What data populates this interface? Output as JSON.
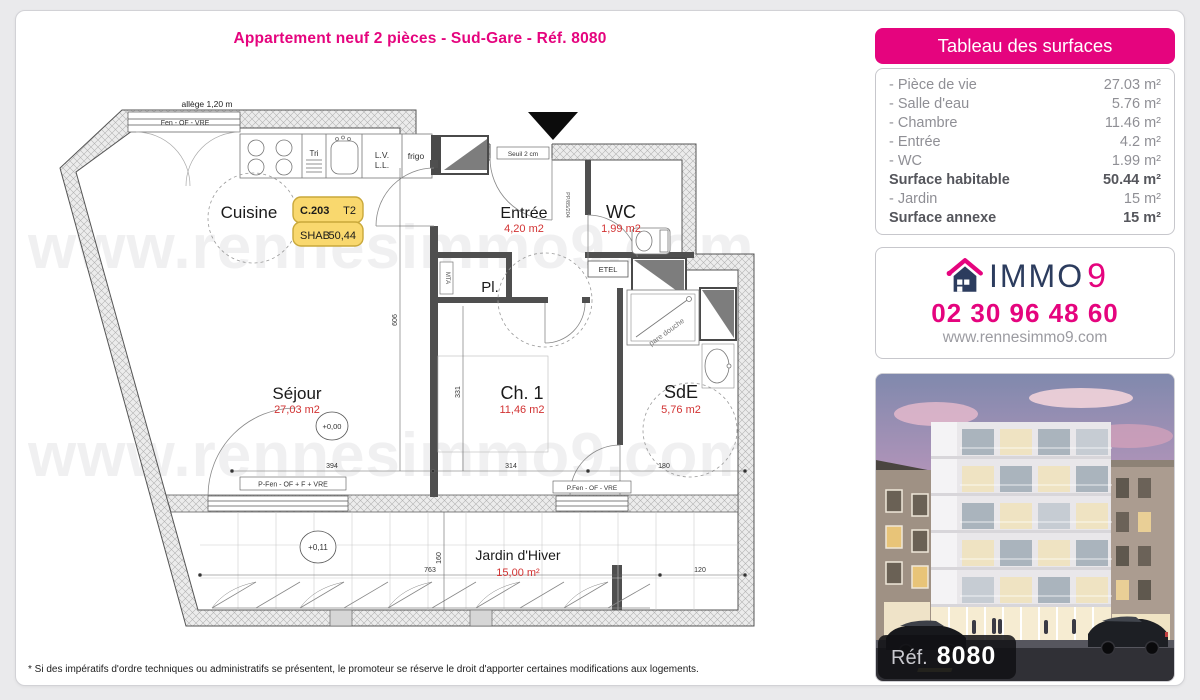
{
  "page": {
    "title": "Appartement neuf 2 pièces - Sud-Gare - Réf. 8080",
    "disclaimer": "* Si des impératifs d'ordre techniques ou administratifs se présentent, le promoteur se réserve le droit d'apporter certaines modifications aux logements."
  },
  "surfaces": {
    "header": "Tableau des surfaces",
    "rows": [
      {
        "label": "- Pièce de vie",
        "value": "27.03 m²"
      },
      {
        "label": "- Salle d'eau",
        "value": "5.76 m²"
      },
      {
        "label": "- Chambre",
        "value": "11.46 m²"
      },
      {
        "label": "- Entrée",
        "value": "4.2 m²"
      },
      {
        "label": "- WC",
        "value": "1.99 m²"
      },
      {
        "label": "Surface habitable",
        "value": "50.44 m²"
      },
      {
        "label": "- Jardin",
        "value": "15 m²"
      },
      {
        "label": "Surface annexe",
        "value": "15 m²"
      }
    ]
  },
  "agency": {
    "brand_main": "IMMO",
    "brand_digit": "9",
    "phone": "02 30 96 48 60",
    "website": "www.rennesimmo9.com"
  },
  "photo": {
    "ref_label": "Réf.",
    "ref_value": "8080"
  },
  "plan": {
    "watermark": "www.rennesimmo9.com",
    "unit_badge": {
      "unit": "C.203",
      "type": "T2",
      "shab_label": "SHAB",
      "shab_value": "50,44"
    },
    "rooms": {
      "cuisine": {
        "name": "Cuisine"
      },
      "sejour": {
        "name": "Séjour",
        "area": "27,03 m2"
      },
      "entree": {
        "name": "Entrée",
        "area": "4,20 m2"
      },
      "wc": {
        "name": "WC",
        "area": "1,99 m2"
      },
      "placard": {
        "name": "Pl."
      },
      "chambre": {
        "name": "Ch. 1",
        "area": "11,46 m2"
      },
      "sde": {
        "name": "SdE",
        "area": "5,76 m2"
      },
      "jardin": {
        "name": "Jardin d'Hiver",
        "area": "15,00 m²"
      }
    },
    "labels": {
      "allege": "allège 1,20 m",
      "fen_top": "Fen - OF - VRE",
      "seuil": "Seuil 2 cm",
      "pfen_sejour": "P-Fen - OF + F + VRE",
      "pfen_ch": "P.Fen - OF - VRE",
      "etel": "ETEL",
      "mta": "MTA",
      "pare_douche": "pare douche",
      "pp": "PP/85/204",
      "tri": "Tri",
      "lv": "L.V.",
      "ll": "L.L.",
      "frigo": "frigo",
      "level_main": "+0,00",
      "level_jardin": "+0,11"
    },
    "dims": {
      "d394": "394",
      "d314": "314",
      "d180": "180",
      "d763": "763",
      "d120": "120",
      "d606": "606",
      "d331": "331",
      "d160": "160"
    }
  },
  "colors": {
    "accent": "#e5047e",
    "navy": "#2c3c5e",
    "area_red": "#d23333"
  }
}
